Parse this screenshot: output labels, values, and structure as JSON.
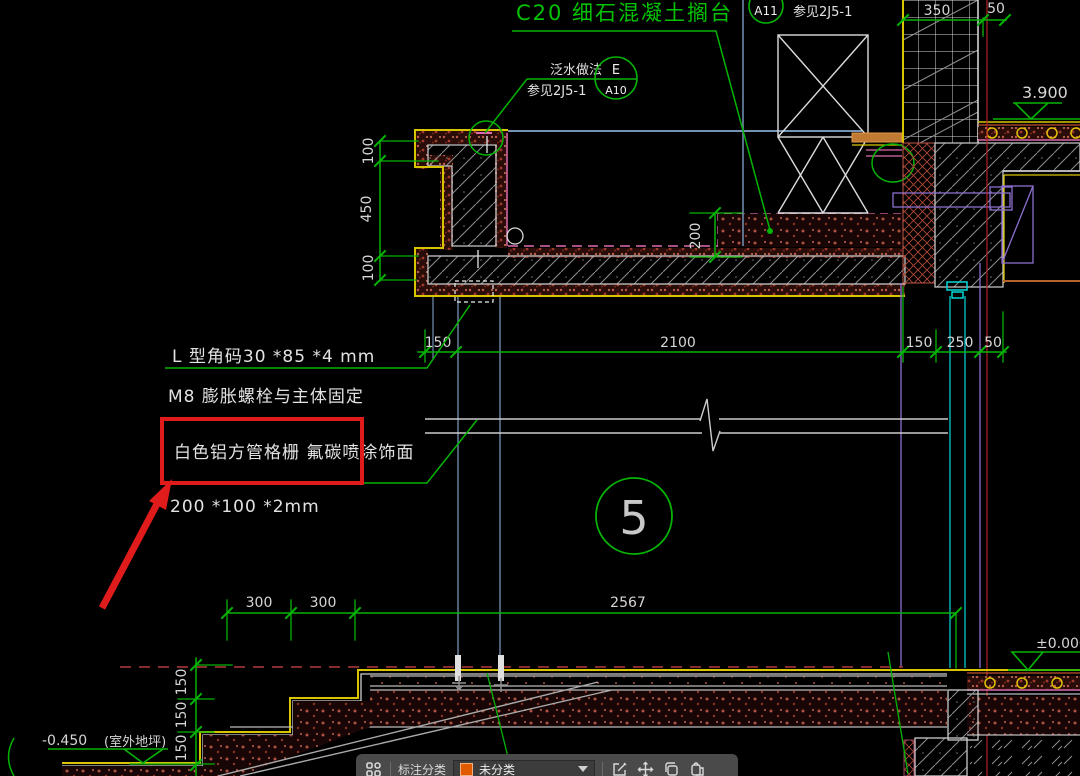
{
  "colors": {
    "dim_green": "#05b405",
    "text_white": "#d6d6d6",
    "yellow": "#d8c500",
    "magenta": "#e06ab0",
    "cyan": "#00c8c8",
    "purple": "#8d6fd0",
    "red_line": "#b42222",
    "annotation_red": "#e01b1b",
    "slate_blue": "#7593b5",
    "toolbar_bg": "#4a4a4a",
    "swatch_orange": "#e05a00"
  },
  "drawing": {
    "title": "C20  细石混凝土搁台",
    "flashing_note": {
      "line1": "泛水做法",
      "line2": "参见2J5-1"
    },
    "detail_bubble": {
      "top": "E",
      "bottom": "A10"
    },
    "ref_bubble": {
      "label": "A11",
      "note": "参见2J5-1"
    },
    "elevations": {
      "floor": "3.900",
      "zero": "±0.000",
      "ground": "-0.450",
      "ground_note": "(室外地坪)"
    },
    "detail_number": "5",
    "notes": {
      "angle": "L 型角码30 *85 *4 mm",
      "anchor": "M8  膨胀螺栓与主体固定",
      "grille": "白色铝方管格栅 氟碳喷涂饰面",
      "size": "200 *100 *2mm"
    },
    "dims": {
      "top_350": "350",
      "top_50": "50",
      "left_100a": "100",
      "left_450": "450",
      "left_100b": "100",
      "depth_200": "200",
      "mid_150a": "150",
      "mid_2100": "2100",
      "mid_150b": "150",
      "mid_250": "250",
      "mid_50": "50",
      "bot_300a": "300",
      "bot_300b": "300",
      "bot_2567": "2567",
      "stair_150a": "150",
      "stair_150b": "150",
      "stair_150c": "150"
    }
  },
  "toolbar": {
    "category_label": "标注分类",
    "category_value": "未分类",
    "icons": {
      "apps": "apps-grid-icon",
      "edit": "edit-icon",
      "move": "move-icon",
      "copy": "copy-icon",
      "paste": "paste-icon"
    }
  }
}
